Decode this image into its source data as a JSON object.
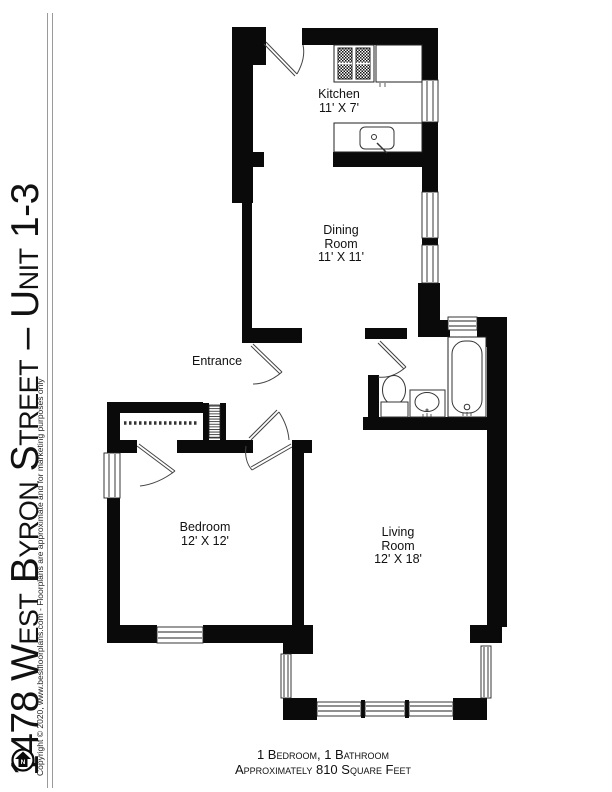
{
  "sidebar": {
    "title": "1478 West Byron Street – Unit 1-3",
    "copyright": "Copyright © 2020, www.bestfloorplans.com - Floorplans are approximate and for marketing purposes only"
  },
  "rooms": {
    "kitchen": {
      "line1": "Kitchen",
      "line2": "11' X 7'"
    },
    "dining": {
      "line1": "Dining",
      "line2": "Room",
      "line3": "11' X 11'"
    },
    "entrance": {
      "line1": "Entrance"
    },
    "bedroom": {
      "line1": "Bedroom",
      "line2": "12' X 12'"
    },
    "living": {
      "line1": "Living",
      "line2": "Room",
      "line3": "12' X 18'"
    }
  },
  "footer": {
    "line1": "1 Bedroom, 1 Bathroom",
    "line2": "Approximately 810 Square Feet"
  },
  "icons": {
    "north_label": "N"
  },
  "colors": {
    "wall": "#0a0a0a",
    "fixture_line": "#333333",
    "rule_line": "#9a9a9a",
    "background": "#ffffff"
  }
}
